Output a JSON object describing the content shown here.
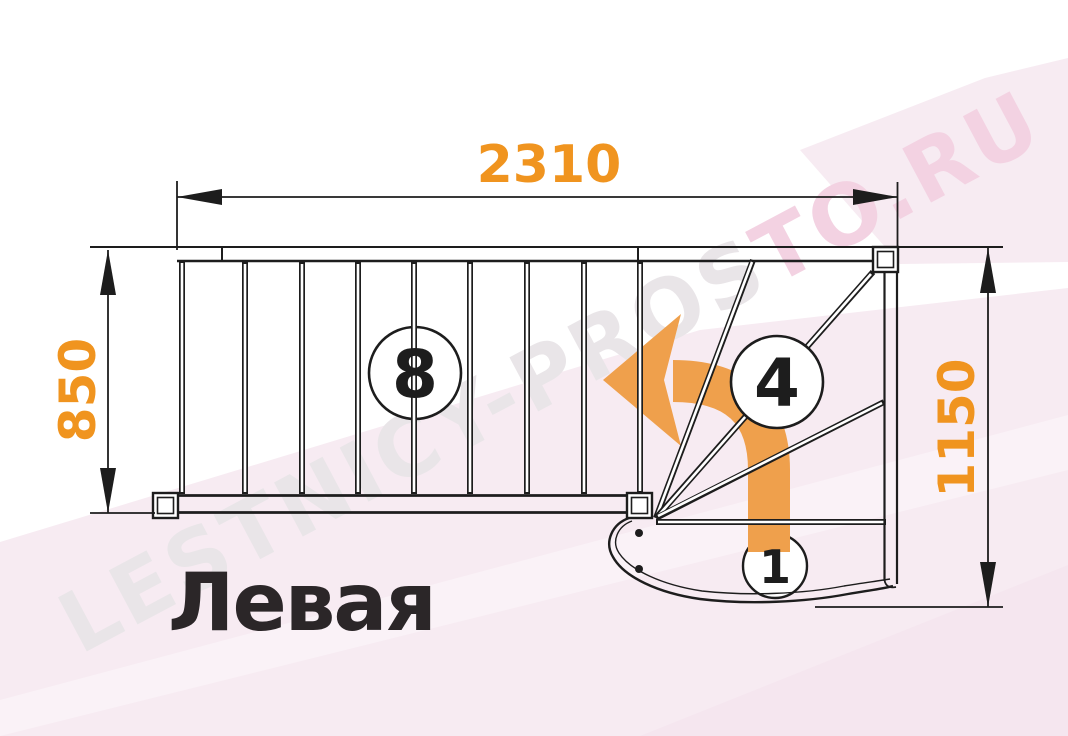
{
  "diagram": {
    "variant_label": "Левая",
    "dimensions_mm": {
      "top_width": "2310",
      "left_depth": "850",
      "right_height": "1150"
    },
    "step_counts": {
      "straight_flight": "8",
      "winder_section": "4",
      "starter_step": "1"
    }
  },
  "watermark": {
    "text_gray": "LESTNICY-PROS",
    "text_pink": "TO.RU"
  },
  "colors": {
    "dimension_text": "#F0941F",
    "arrow": "#EFA04C",
    "line": "#1D1D1D",
    "title_text": "#2B2628",
    "background_pink": "#F7EBF2",
    "background_pink_deep": "#F5E6EF",
    "background_pink_light": "#FAF2F7",
    "watermark_gray": "#E9E5E8",
    "watermark_pink": "#F3D2E2"
  }
}
